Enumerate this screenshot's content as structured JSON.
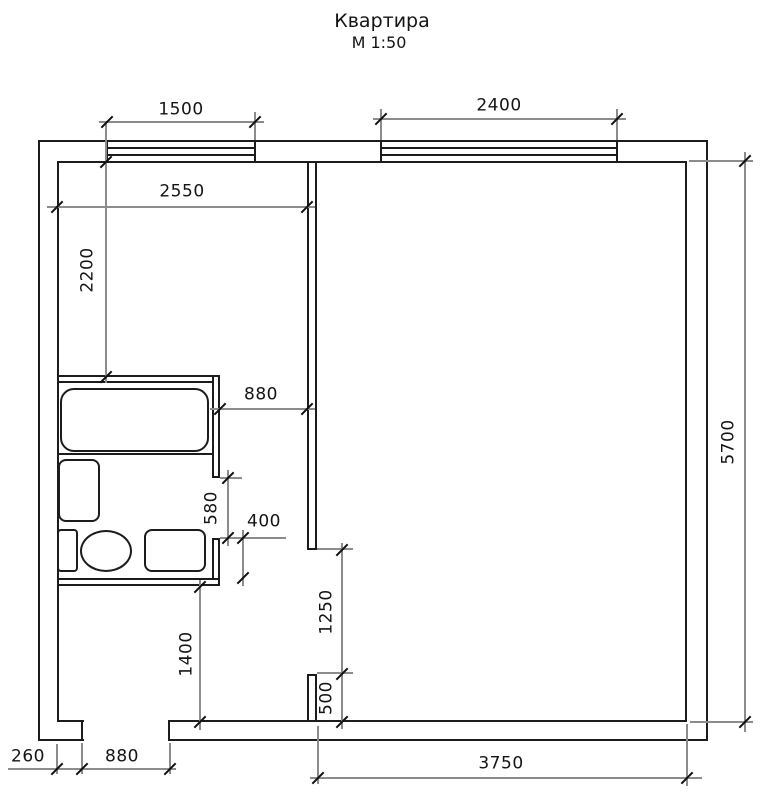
{
  "title": "Квартира",
  "scale_note": "М 1:50",
  "colors": {
    "wall_line": "#1c1c1c",
    "dimension_line": "#8c8c8c",
    "background": "#ffffff"
  },
  "dimensions": {
    "left_window_width": "1500",
    "main_window_width": "2400",
    "left_room_width": "2550",
    "left_room_depth": "2200",
    "bath_passage_width": "880",
    "bath_door_width": "580",
    "bath_door_offset": "400",
    "main_doorway_height": "1250",
    "wall_stub_length": "500",
    "hall_depth": "1400",
    "entry_jamb_width": "260",
    "entry_door_width": "880",
    "main_room_width": "3750",
    "main_room_depth": "5700"
  },
  "fixtures": [
    "bathtub",
    "sink",
    "toilet",
    "washing-machine"
  ]
}
